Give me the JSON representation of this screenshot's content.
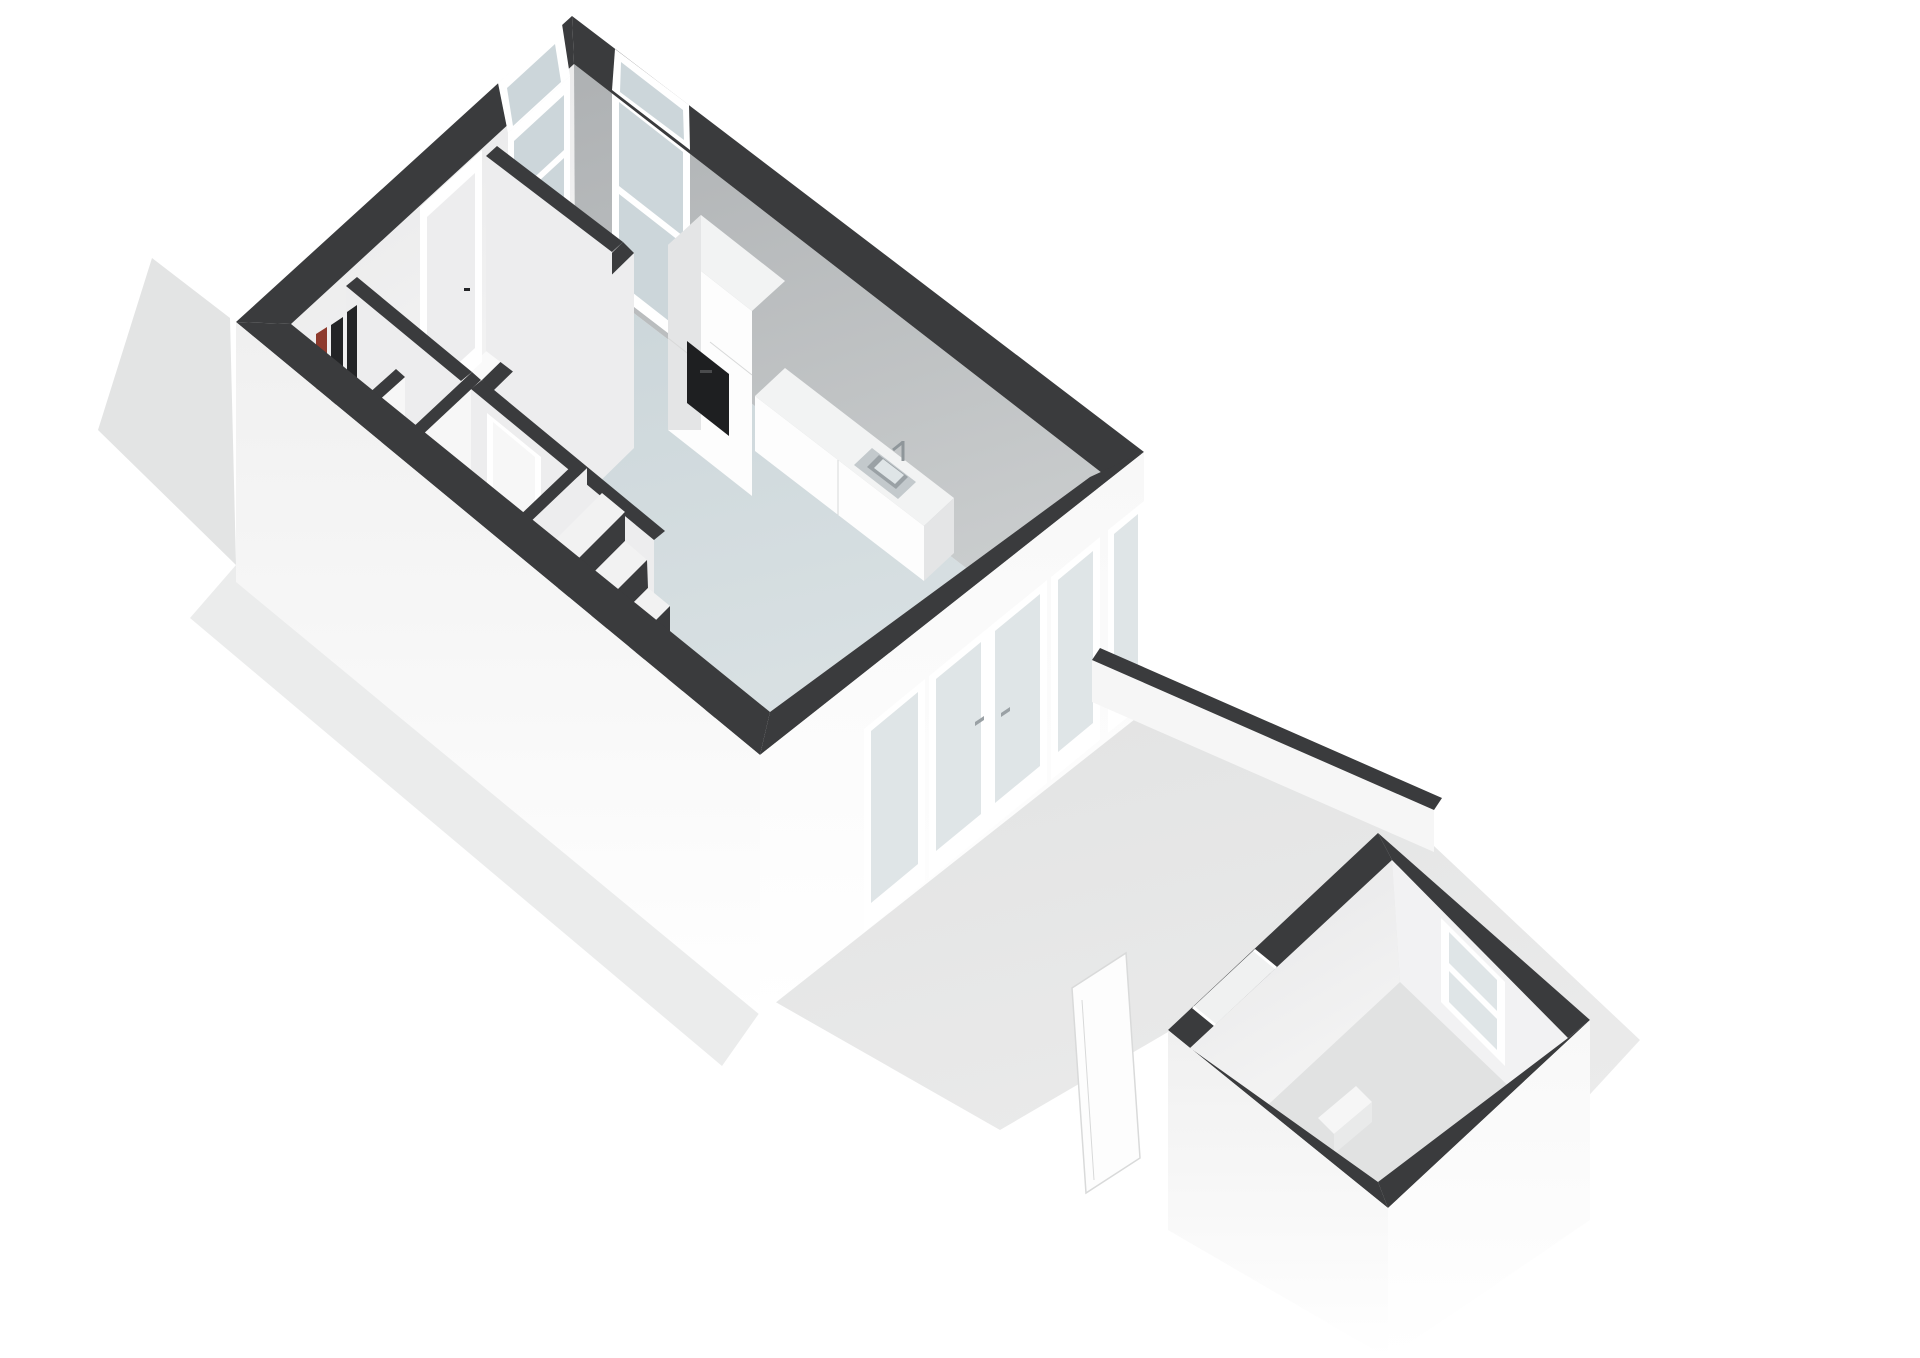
{
  "title": "",
  "visible_text": [],
  "colors": {
    "page": "#ffffff",
    "ground": "#e3e4e4",
    "ground-soft": "#ebecec",
    "patio": "#e6e7e7",
    "wall-top": "#3a3b3d",
    "ext-face": "#f6f6f6",
    "inner-light": "#ededee",
    "inner-lighter": "#f7f7f7",
    "inner-gray": "#b7babc",
    "floor-white": "#fafafa",
    "floor-blue-a": "#c9d4d8",
    "floor-blue-b": "#dde4e6",
    "frame-white": "#ffffff",
    "glass": "#ccd6da",
    "glass-light": "#dfe5e7",
    "cabinet-front": "#fdfdfd",
    "cabinet-side": "#e4e5e6",
    "cabinet-top": "#f2f3f3",
    "oven": "#1e1f21",
    "steel": "#c3c9cc",
    "steel-dark": "#9aa1a5",
    "tread": "#f2f2f2",
    "meter-dark": "#232426",
    "meter-red": "#8d3a2d",
    "fixture": "#ffffff",
    "shed-floor": "#e1e2e2",
    "edge": "#d8d9d9"
  },
  "scene": {
    "type": "3d-floorplan-render",
    "floor_label": "",
    "buildings": [
      {
        "name": "main-house-ground-floor",
        "rooms": [
          "living-kitchen-room",
          "entry-hall",
          "meter-closet",
          "toilet-room",
          "staircase"
        ],
        "fixtures": [
          "kitchen-tall-cabinets",
          "built-in-oven",
          "kitchen-counter",
          "kitchen-sink",
          "kitchen-faucet",
          "front-door",
          "tall-window-nw",
          "tall-window-ne",
          "french-doors",
          "glazed-side-panels",
          "door-handles",
          "stair-treads",
          "toilet",
          "meter-boxes"
        ]
      },
      {
        "name": "garden-shed",
        "rooms": [
          "shed-room"
        ],
        "fixtures": [
          "shed-window",
          "shed-door-opening",
          "loose-door-panel",
          "shed-step"
        ]
      }
    ],
    "outdoor": [
      "front-garden-strip",
      "side-garden-strip",
      "back-patio",
      "garden-fence"
    ]
  }
}
